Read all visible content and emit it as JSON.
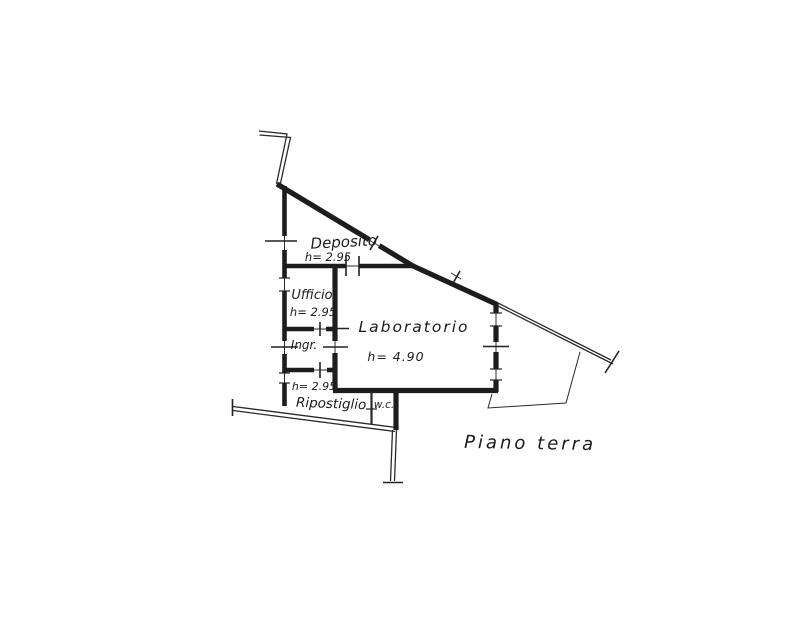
{
  "document": {
    "type": "floor-plan-sketch",
    "floor_label": "Piano terra"
  },
  "colors": {
    "ink": "#1d1d1d",
    "background": "#ffffff"
  },
  "rooms": [
    {
      "name": "Deposito",
      "height": "h= 2.95"
    },
    {
      "name": "Ufficio",
      "height": "h= 2.95"
    },
    {
      "name": "Ingr."
    },
    {
      "name": "Ripostiglio",
      "height": "h= 2.95"
    },
    {
      "name": "w.c."
    },
    {
      "name": "Laboratorio",
      "height": "h= 4.90"
    }
  ]
}
